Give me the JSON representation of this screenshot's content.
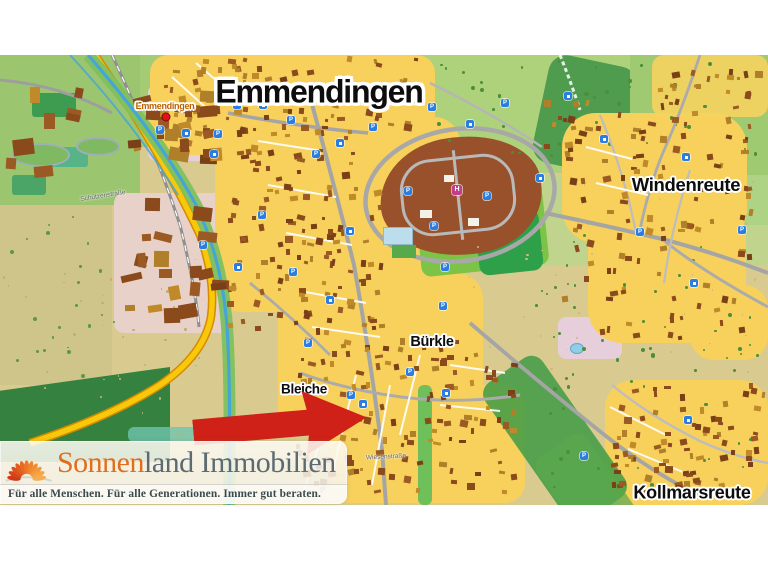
{
  "window": {
    "background": "#ffffff"
  },
  "map": {
    "place_labels": [
      {
        "name": "map-title",
        "text": "Emmendingen",
        "x": 319,
        "y": 37,
        "size": 32,
        "major": true
      },
      {
        "name": "city-label-emmendingen",
        "text": "Emmendingen",
        "x": 165,
        "y": 51,
        "size": 9,
        "color": "#bc5f00"
      },
      {
        "name": "district-label-windenreute",
        "text": "Windenreute",
        "x": 686,
        "y": 130,
        "size": 18.5
      },
      {
        "name": "district-label-buerkle",
        "text": "Bürkle",
        "x": 432,
        "y": 287,
        "size": 14.5
      },
      {
        "name": "district-label-bleiche",
        "text": "Bleiche",
        "x": 304,
        "y": 334,
        "size": 13.5
      },
      {
        "name": "district-label-kollmarsreute",
        "text": "Kollmarsreute",
        "x": 692,
        "y": 438,
        "size": 18
      }
    ],
    "street_labels": [
      {
        "text": "Schützenstraße",
        "x": 103,
        "y": 141,
        "angle": -9
      },
      {
        "text": "Wiesenstraße",
        "x": 386,
        "y": 402,
        "angle": -3
      }
    ],
    "marker_colors": {
      "parking": "#2a7de1",
      "hospital": "#c73b8f"
    },
    "marker_glyphs": {
      "parking": "P",
      "hospital": "H"
    },
    "markers": [
      [
        160,
        75,
        "p"
      ],
      [
        186,
        78,
        "s"
      ],
      [
        218,
        79,
        "p"
      ],
      [
        237,
        50,
        "p"
      ],
      [
        263,
        50,
        "s"
      ],
      [
        291,
        65,
        "p"
      ],
      [
        214,
        99,
        "s"
      ],
      [
        316,
        99,
        "p"
      ],
      [
        340,
        88,
        "s"
      ],
      [
        373,
        72,
        "p"
      ],
      [
        432,
        52,
        "p"
      ],
      [
        470,
        69,
        "s"
      ],
      [
        505,
        48,
        "p"
      ],
      [
        540,
        123,
        "s"
      ],
      [
        434,
        171,
        "p"
      ],
      [
        350,
        176,
        "s"
      ],
      [
        293,
        217,
        "p"
      ],
      [
        330,
        245,
        "s"
      ],
      [
        445,
        212,
        "p"
      ],
      [
        487,
        141,
        "p"
      ],
      [
        408,
        136,
        "p"
      ],
      [
        351,
        340,
        "p"
      ],
      [
        363,
        349,
        "s"
      ],
      [
        410,
        317,
        "p"
      ],
      [
        446,
        338,
        "s"
      ],
      [
        308,
        288,
        "p"
      ],
      [
        686,
        102,
        "s"
      ],
      [
        640,
        177,
        "p"
      ],
      [
        604,
        84,
        "s"
      ],
      [
        742,
        175,
        "p"
      ],
      [
        694,
        228,
        "s"
      ],
      [
        584,
        401,
        "p"
      ],
      [
        688,
        365,
        "s"
      ],
      [
        443,
        251,
        "p"
      ],
      [
        568,
        41,
        "s"
      ],
      [
        262,
        160,
        "p"
      ],
      [
        203,
        190,
        "p"
      ],
      [
        238,
        212,
        "s"
      ],
      [
        457,
        135,
        "h"
      ]
    ],
    "city_dot": {
      "x": 166,
      "y": 62,
      "color": "#e31219"
    }
  },
  "arrow": {
    "color": "#cf2117"
  },
  "branding": {
    "name_accent": "Sonnen",
    "name_rest": "land Immobilien",
    "accent_color": "#df6f1e",
    "rest_color": "#5c6a72",
    "tagline": "Für alle Menschen. Für alle Generationen. Immer gut beraten.",
    "tagline_color": "#3a4b50"
  }
}
